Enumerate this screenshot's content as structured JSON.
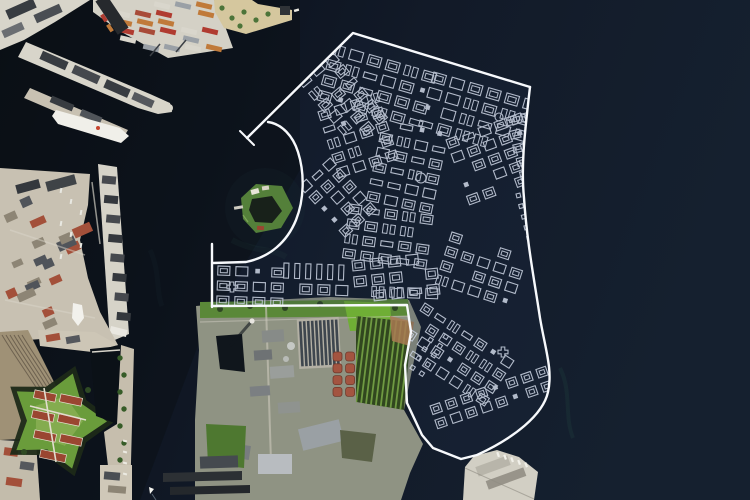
{
  "map": {
    "kind": "satellite-aerial-view-with-plan-overlay",
    "regions": [
      "open-sea",
      "harbor-channel",
      "nordhavn-piers",
      "container-terminal",
      "harbor-park-jetty",
      "langelinie-pier",
      "west-shore-city",
      "railway-yard",
      "kastellet-fortress",
      "coast-road",
      "trekroner-island",
      "refshaleoen-area",
      "treatment-plant",
      "allotment-gardens",
      "south-pier",
      "plan-overlay"
    ]
  },
  "colors": {
    "water_dark": "#0a1016",
    "water_mid": "#0d1420",
    "water_light": "#121a28",
    "water_far": "#15202f",
    "algae": "#2a5c52",
    "concrete": "#d8d5ca",
    "concrete_dim": "#c8c1b2",
    "roof_dark": "#383c41",
    "roof_red": "#a3503a",
    "green_bright": "#6fae35",
    "green_mid": "#5a8838",
    "green_dark": "#2f4a24",
    "tan": "#d5c79e",
    "rail": "#9f9176",
    "basin": "#3e464e",
    "tank_red": "#a35440",
    "plan_line": "#c9d1e0",
    "plan_boundary": "#f7f9fc"
  },
  "plan_overlay": {
    "boundary_paths": {
      "ne_edge": "M247,138 L353,33 L530,87",
      "east_tail": "M530,87 C524,138 521,168 524,198 C527,243 534,278 540,318 C545,348 553,370 548,392 C543,415 514,438 477,455 L461,459 L433,448 L422,435 L407,403 L405,365 L411,332 L407,305 L212,306",
      "left_edge": "M212,307 L212,244",
      "island_curve": "M268,122 C282,124 293,136 298,152 C305,174 304,200 296,220 C287,242 270,257 246,262 L213,263",
      "clip": "M353,33 L530,87 C524,138 521,168 524,198 C527,243 534,278 540,318 C545,348 553,370 548,392 C543,415 514,438 477,455 L461,459 L433,448 L422,435 L407,403 L405,365 L411,332 L407,305 L212,306 L212,263 L246,262 C270,257 287,242 296,220 C304,200 305,174 298,152 C293,136 282,124 268,122 Z"
    },
    "ticks": [
      "M240,131 L254,145"
    ],
    "clusters": [
      {
        "x": 299,
        "y": 82,
        "rot": -40,
        "cols": 3,
        "rows": 6,
        "cw": 14,
        "ch": 12
      },
      {
        "x": 333,
        "y": 44,
        "rot": 16,
        "cols": 6,
        "rows": 4,
        "cw": 16,
        "ch": 13
      },
      {
        "x": 434,
        "y": 72,
        "rot": 16,
        "cols": 6,
        "rows": 4,
        "cw": 16,
        "ch": 13
      },
      {
        "x": 318,
        "y": 112,
        "rot": -18,
        "cols": 4,
        "rows": 5,
        "cw": 14,
        "ch": 12
      },
      {
        "x": 384,
        "y": 118,
        "rot": 12,
        "cols": 4,
        "rows": 6,
        "cw": 15,
        "ch": 12
      },
      {
        "x": 446,
        "y": 140,
        "rot": -20,
        "cols": 5,
        "rows": 5,
        "cw": 14,
        "ch": 12
      },
      {
        "x": 506,
        "y": 118,
        "rot": -14,
        "cols": 2,
        "rows": 7,
        "cw": 13,
        "ch": 11
      },
      {
        "x": 299,
        "y": 186,
        "rot": -42,
        "cols": 3,
        "rows": 5,
        "cw": 13,
        "ch": 12
      },
      {
        "x": 350,
        "y": 204,
        "rot": 8,
        "cols": 5,
        "rows": 4,
        "cw": 15,
        "ch": 12
      },
      {
        "x": 452,
        "y": 232,
        "rot": 18,
        "cols": 5,
        "rows": 4,
        "cw": 14,
        "ch": 12
      },
      {
        "x": 218,
        "y": 266,
        "rot": 2,
        "cols": 4,
        "rows": 3,
        "cw": 15,
        "ch": 12
      },
      {
        "x": 284,
        "y": 263,
        "rot": 2,
        "cols": 6,
        "rows": 1,
        "cw": 8,
        "ch": 15,
        "style": "bars"
      },
      {
        "x": 300,
        "y": 284,
        "rot": 2,
        "cols": 8,
        "rows": 1,
        "cw": 15,
        "ch": 13
      },
      {
        "x": 352,
        "y": 261,
        "rot": -6,
        "cols": 5,
        "rows": 3,
        "cw": 15,
        "ch": 13
      },
      {
        "x": 425,
        "y": 303,
        "rot": 33,
        "cols": 7,
        "rows": 4,
        "cw": 13,
        "ch": 12
      },
      {
        "x": 430,
        "y": 406,
        "rot": -19,
        "cols": 8,
        "rows": 2,
        "cw": 13,
        "ch": 12
      },
      {
        "x": 516,
        "y": 194,
        "rot": -14,
        "cols": 2,
        "rows": 5,
        "cw": 8,
        "ch": 8,
        "style": "dots"
      },
      {
        "x": 436,
        "y": 328,
        "rot": 33,
        "cols": 2,
        "rows": 5,
        "cw": 8,
        "ch": 8,
        "style": "dots"
      }
    ],
    "specials": {
      "circles": [
        [
          421,
          178,
          5
        ],
        [
          499,
          117,
          4
        ]
      ],
      "crosses": [
        [
          503,
          352
        ],
        [
          232,
          287
        ]
      ]
    }
  }
}
